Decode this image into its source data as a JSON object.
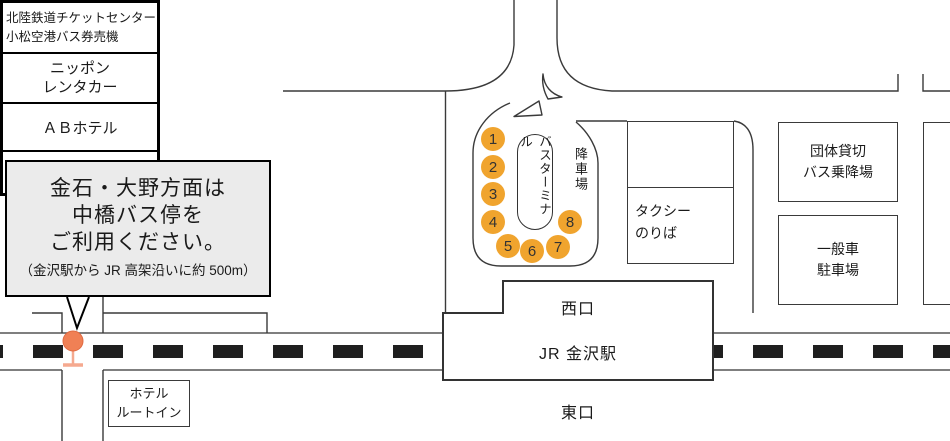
{
  "callout": {
    "line1": "金石・大野方面は",
    "line2": "中橋バス停を",
    "line3": "ご利用ください。",
    "note": "（金沢駅から JR 高架沿いに約 500m）"
  },
  "buildings": {
    "ticket_line1": "北陸鉄道チケットセンター",
    "ticket_line2": "小松空港バス券売機",
    "rentacar_line1": "ニッポン",
    "rentacar_line2": "レンタカー",
    "ab_hotel": "ＡＢホテル",
    "lawson": "ローソン"
  },
  "terminal": {
    "label": "バスターミナル",
    "drop_off": "降車場",
    "stops": [
      "1",
      "2",
      "3",
      "4",
      "5",
      "6",
      "7",
      "8"
    ]
  },
  "taxi": {
    "line1": "タクシー",
    "line2": "のりば"
  },
  "group_bus": {
    "line1": "団体貸切",
    "line2": "バス乗降場"
  },
  "parking": {
    "line1": "一般車",
    "line2": "駐車場"
  },
  "station": {
    "west": "西口",
    "name": "JR 金沢駅",
    "east": "東口"
  },
  "hotel_route_inn": {
    "line1": "ホテル",
    "line2": "ルートイン"
  },
  "colors": {
    "stop_circle": "#F0A42E",
    "pin": "#F08055",
    "pin_stem": "#F5A98F",
    "road_line": "#3a3a3a",
    "callout_bg": "#ebebeb"
  }
}
